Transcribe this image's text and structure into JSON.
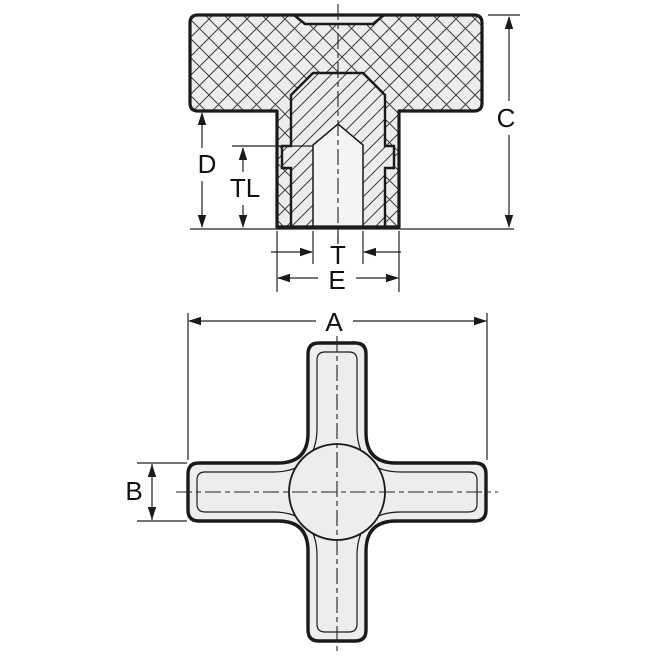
{
  "drawing": {
    "kind": "technical-dimension-drawing",
    "subject": "cross knob with blind tapped insert",
    "views": {
      "section": {
        "name": "front-section-view",
        "dims": {
          "overall_height": "C",
          "hub_depth": "D",
          "thread_length": "TL",
          "thread": "T",
          "hub_diameter": "E"
        }
      },
      "plan": {
        "name": "bottom-plan-view",
        "dims": {
          "overall_width": "A",
          "arm_width": "B"
        }
      }
    },
    "colors": {
      "line": "#1a1a1a",
      "dim_line": "#222222",
      "fill": "#ededed",
      "hole_fill": "#f4f4f4",
      "background": "#ffffff"
    }
  }
}
